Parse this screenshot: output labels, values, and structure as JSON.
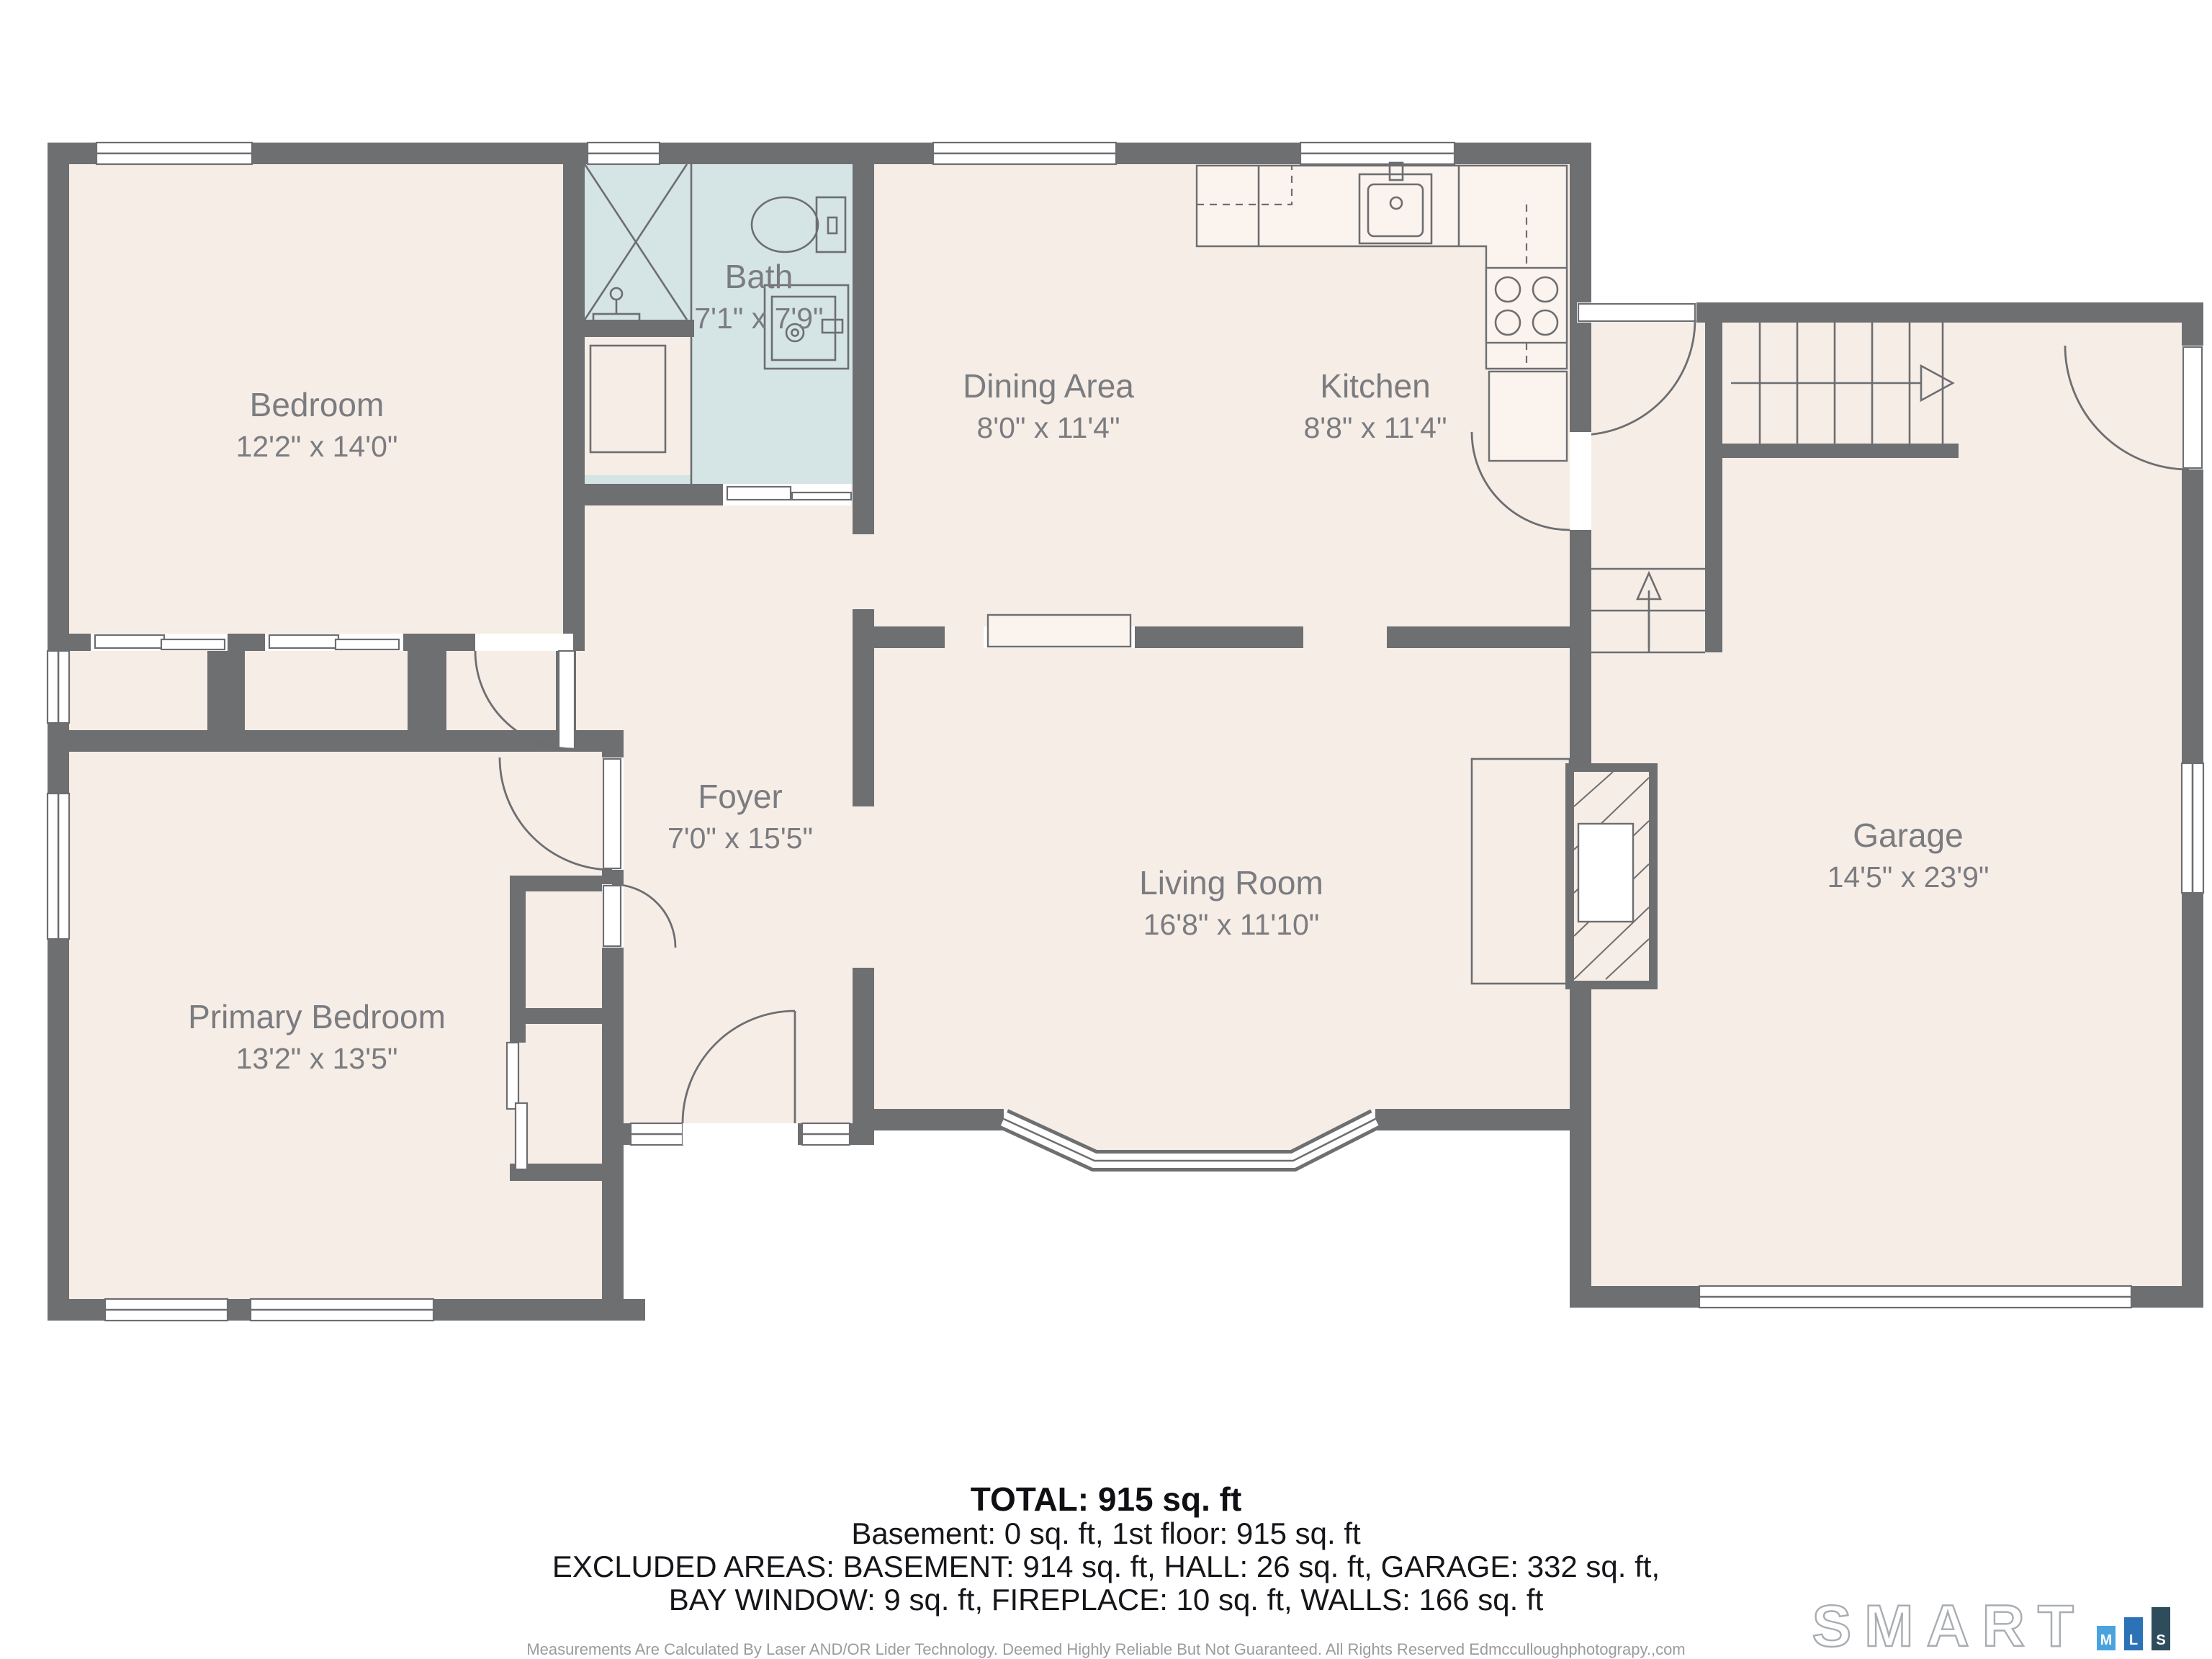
{
  "floor_plan": {
    "rooms": [
      {
        "name": "Bedroom",
        "dims": "12'2\" x 14'0\""
      },
      {
        "name": "Bath",
        "dims": "7'1\" x 7'9\""
      },
      {
        "name": "Dining Area",
        "dims": "8'0\" x 11'4\""
      },
      {
        "name": "Kitchen",
        "dims": "8'8\" x 11'4\""
      },
      {
        "name": "Foyer",
        "dims": "7'0\" x 15'5\""
      },
      {
        "name": "Primary Bedroom",
        "dims": "13'2\" x 13'5\""
      },
      {
        "name": "Living Room",
        "dims": "16'8\" x 11'10\""
      },
      {
        "name": "Garage",
        "dims": "14'5\" x 23'9\""
      }
    ],
    "colors": {
      "wall": "#6e6f71",
      "floor": "#f6ede7",
      "bath_floor": "#d5e4e5",
      "label_text": "#7b7c80"
    }
  },
  "summary": {
    "total": "TOTAL: 915 sq. ft",
    "line2": "Basement: 0 sq. ft, 1st floor: 915 sq. ft",
    "line3": "EXCLUDED AREAS: BASEMENT: 914 sq. ft, HALL: 26 sq. ft, GARAGE: 332 sq. ft,",
    "line4": "BAY WINDOW: 9 sq. ft, FIREPLACE: 10 sq. ft, WALLS: 166 sq. ft"
  },
  "disclaimer": "Measurements Are Calculated By Laser AND/OR Lider Technology. Deemed Highly Reliable But Not Guaranteed. All Rights Reserved Edmcculloughphotograpy.,com",
  "logo": {
    "wordmark": "SMART",
    "bars": [
      {
        "letter": "M",
        "color": "#4aa3dd"
      },
      {
        "letter": "L",
        "color": "#2b73b6"
      },
      {
        "letter": "S",
        "color": "#2e4c5c"
      }
    ]
  }
}
